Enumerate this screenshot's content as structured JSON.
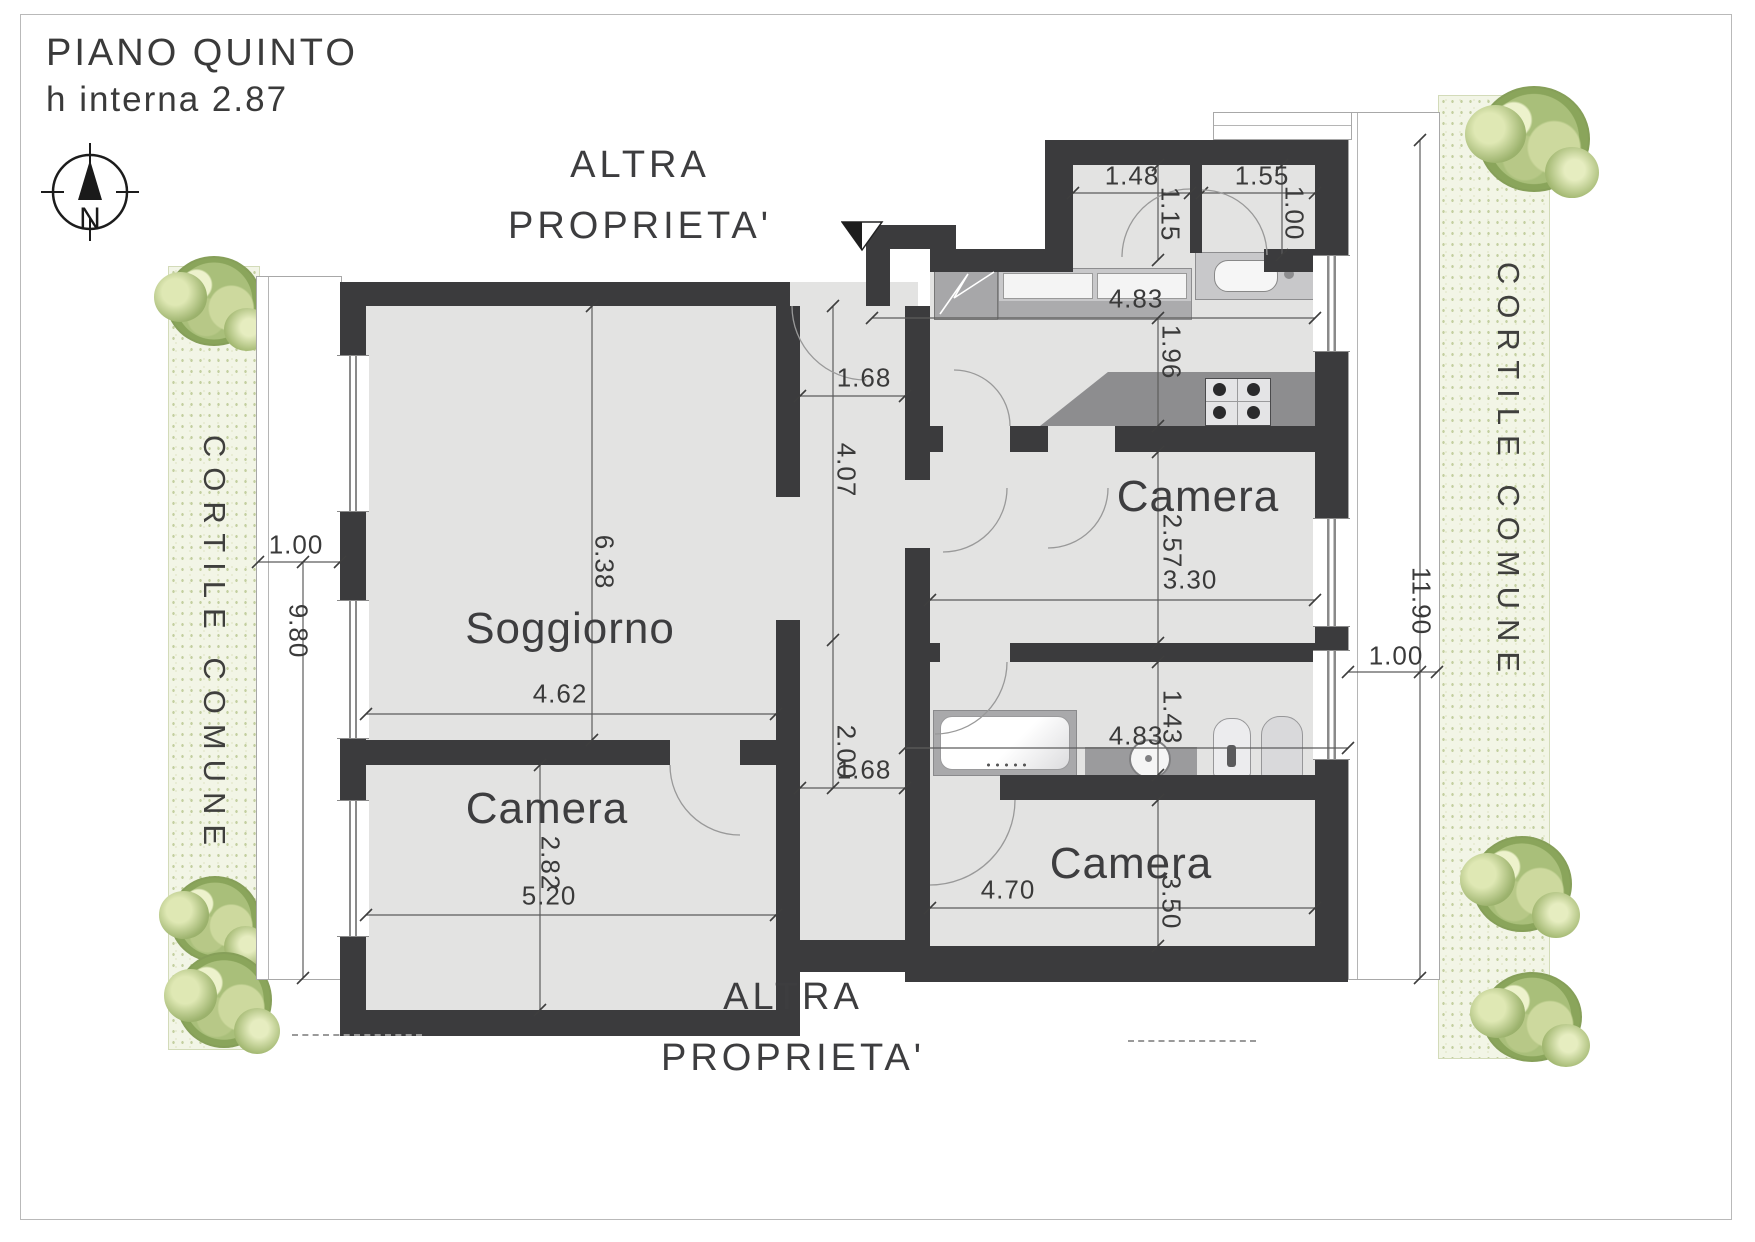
{
  "header": {
    "floor_title": "PIANO QUINTO",
    "height_note": "h interna 2.87",
    "compass_north": "N"
  },
  "surroundings": {
    "top_property": {
      "line1": "ALTRA",
      "line2": "PROPRIETA'"
    },
    "bottom_property": {
      "line1": "ALTRA",
      "line2": "PROPRIETA'"
    },
    "left_courtyard": "CORTILE COMUNE",
    "right_courtyard": "CORTILE COMUNE"
  },
  "rooms": {
    "soggiorno": {
      "label": "Soggiorno",
      "width_m": "4.62",
      "length_m": "6.38"
    },
    "camera_nord": {
      "label": "Camera",
      "width_m": "3.30",
      "depth_m": "2.57"
    },
    "camera_sud": {
      "label": "Camera",
      "width_m": "4.70",
      "depth_m": "3.50"
    },
    "camera_ovest": {
      "label": "Camera",
      "width_m": "5.20",
      "depth_m": "2.82"
    },
    "cucina": {
      "width_m": "4.83",
      "depth_m": "1.96"
    },
    "bagno": {
      "width_m": "4.83",
      "depth_m": "1.43"
    },
    "disimpegno": {
      "upper_width_m": "1.68",
      "upper_length_m": "4.07",
      "lower_length_m": "2.00",
      "lower_width_m": "1.68"
    },
    "ingresso_sx": {
      "width_m": "1.48",
      "depth_m": "1.15"
    },
    "ingresso_dx": {
      "width_m": "1.55",
      "depth_m": "1.00"
    }
  },
  "balconies": {
    "left": {
      "width_m": "1.00",
      "length_m": "9.80"
    },
    "right": {
      "width_m": "1.00",
      "length_m": "11.90"
    }
  }
}
